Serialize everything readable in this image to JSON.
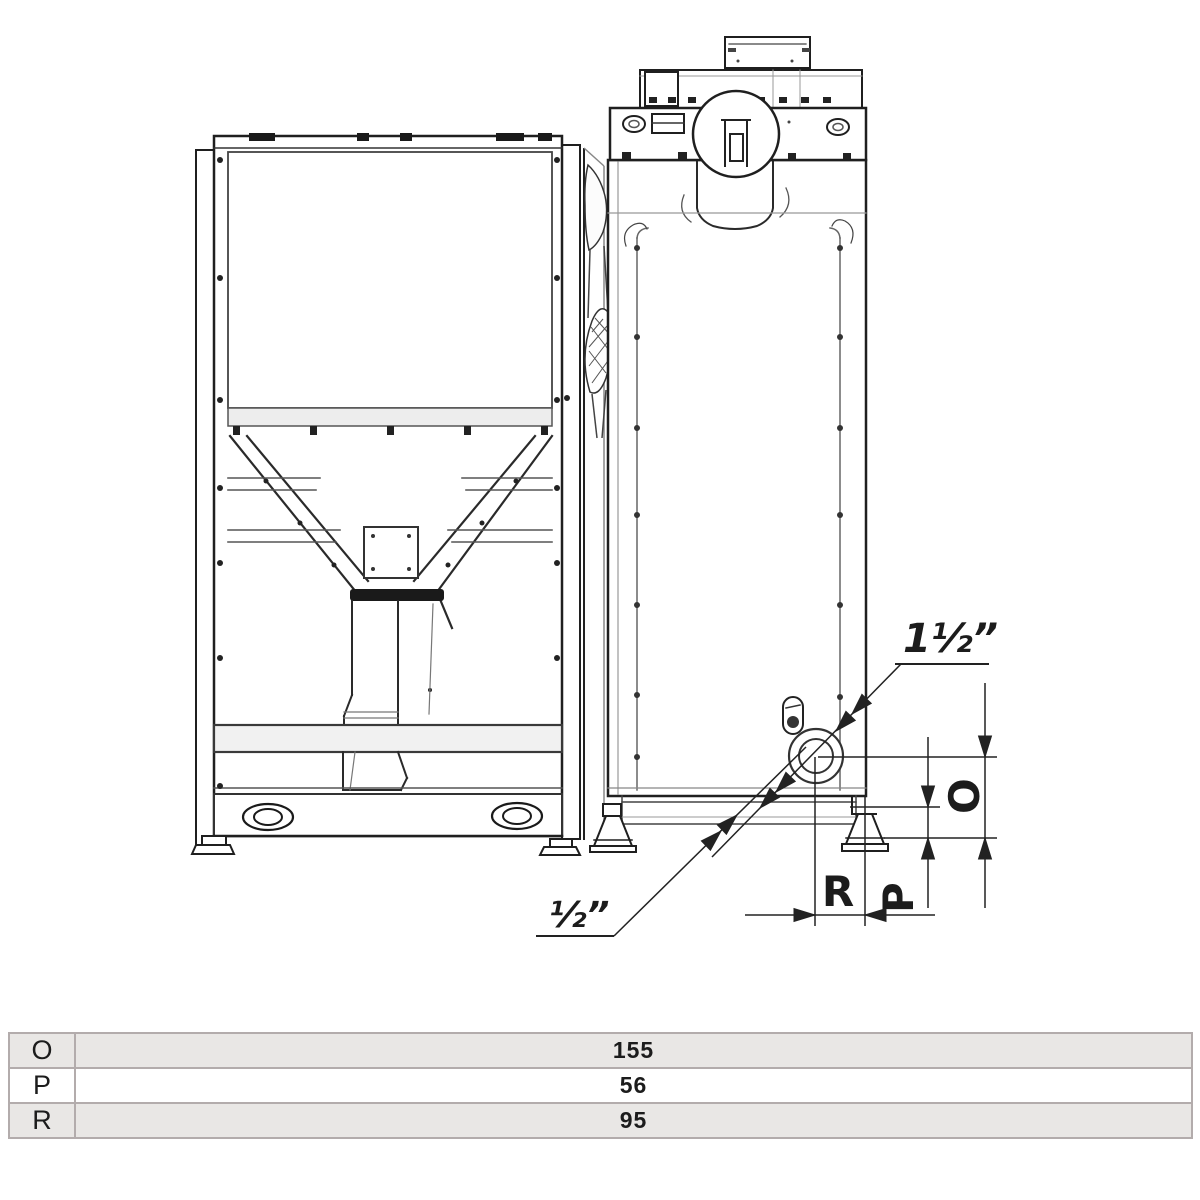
{
  "drawing": {
    "labels": {
      "top_connection": "1½”",
      "bottom_connection": "½”",
      "dim_o": "O",
      "dim_p": "P",
      "dim_r": "R"
    }
  },
  "table": {
    "rows": [
      {
        "param": "O",
        "value": "155"
      },
      {
        "param": "P",
        "value": "56"
      },
      {
        "param": "R",
        "value": "95"
      }
    ]
  },
  "colors": {
    "line_dark": "#1f1f1f",
    "line_mid": "#555555",
    "line_light": "#999999",
    "dim_line": "#222222",
    "table_border": "#b3acac",
    "table_row_shaded": "#e9e7e5",
    "table_row_plain": "#ffffff",
    "text": "#1c1c1c"
  }
}
